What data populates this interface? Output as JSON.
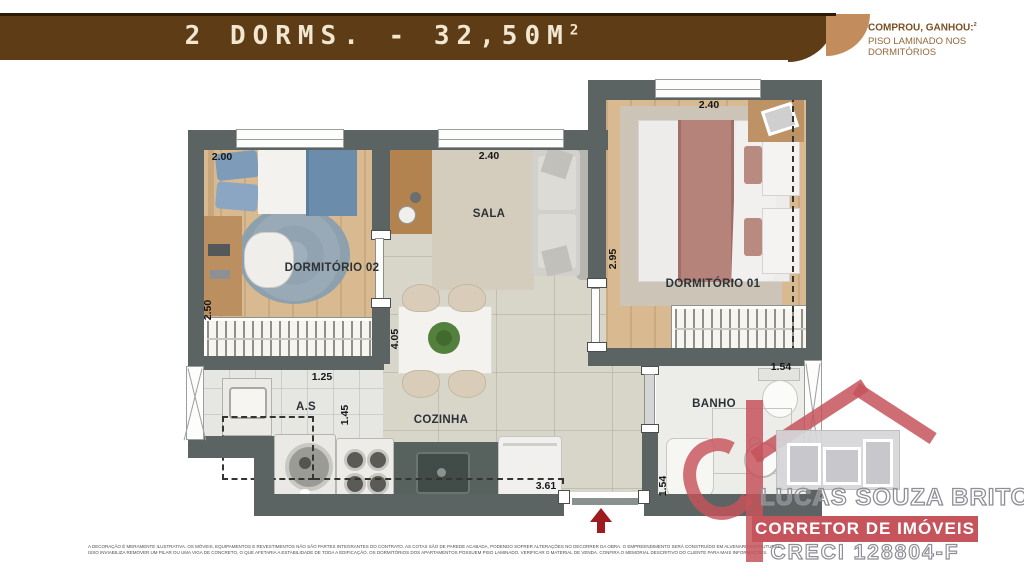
{
  "header": {
    "title_main": "2 DORMS. - 32,50M",
    "title_sup": "2",
    "promo_line1": "COMPROU, GANHOU:",
    "promo_sup": "2",
    "promo_line2": "PISO LAMINADO NOS DORMITÓRIOS",
    "band_color": "#5e3c16",
    "band_tail_color": "#c28c5c",
    "title_color": "#f1e7d1",
    "promo_color": "#7d4f22"
  },
  "floorplan": {
    "room_labels": {
      "dorm02": "DORMITÓRIO 02",
      "sala": "SALA",
      "dorm01": "DORMITÓRIO 01",
      "cozinha": "COZINHA",
      "as": "A.S",
      "banho": "BANHO"
    },
    "dims": {
      "dorm02_w": "2.00",
      "dorm02_h": "2.50",
      "sala_w": "2.40",
      "sala_dorm01_h": "2.95",
      "dorm01_w": "2.40",
      "cozinha_h": "4.05",
      "as_w": "1.25",
      "as_h": "1.45",
      "cozinha_w": "3.61",
      "banho_w": "1.54",
      "banho_h": "1.54"
    },
    "wall_color": "#5b6462",
    "entry_arrow_color": "#9e1b20"
  },
  "watermark": {
    "name": "LUCAS SOUZA BRITO",
    "role": "CORRETOR DE IMÓVEIS",
    "creci": "CRECI 128804-F",
    "accent_color": "#c6545c"
  },
  "disclaimer": {
    "line1": "A DECORAÇÃO É MERAMENTE ILUSTRATIVA. OS MÓVEIS, EQUIPAMENTOS E REVESTIMENTOS NÃO SÃO PARTES INTEGRANTES DO CONTRATO. AS COTAS SÃO DE PAREDE ACABADA, PODENDO SOFRER ALTERAÇÕES NO DECORRER DA OBRA. O EMPREENDIMENTO SERÁ CONSTRUÍDO EM ALVENARIA ESTRUTURAL,",
    "line2": "ISSO INVIABILIZA REMOVER UM PILAR OU UMA VIGA DE CONCRETO, O QUE AFETARIA A ESTABILIDADE DE TODA A EDIFICAÇÃO. OS DORMITÓRIOS DOS APARTAMENTOS POSSUEM PISO LAMINADO. VERIFICAR O MATERIAL DE VENDA. CONFIRA O MEMORIAL DESCRITIVO DO CLIENTE PARA MAIS INFORMAÇÕES."
  }
}
